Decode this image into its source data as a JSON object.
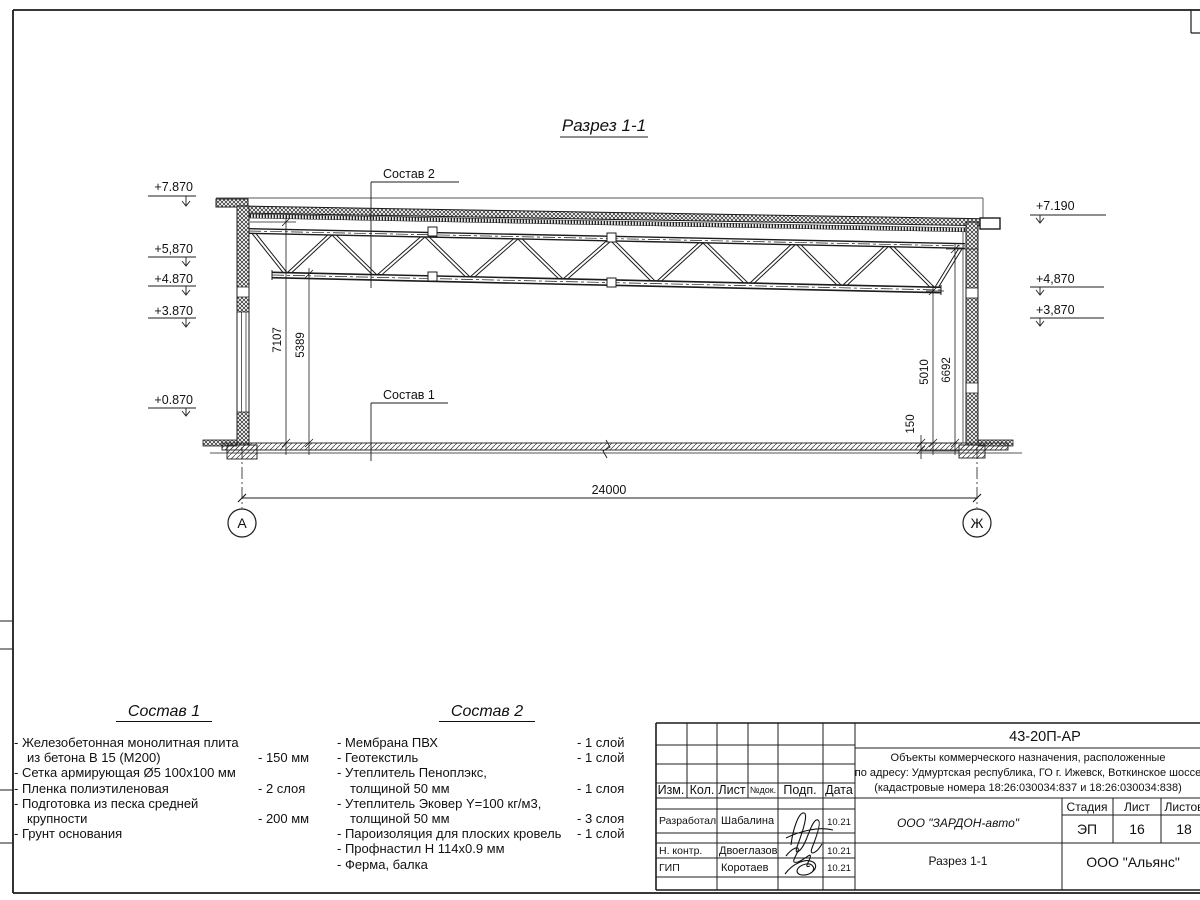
{
  "page": {
    "sheet_title": "Разрез 1-1"
  },
  "drawing": {
    "title": "Разрез 1-1",
    "leader1": "Состав 1",
    "leader2": "Состав 2",
    "dim_width": "24000",
    "dim_h_left1": "7107",
    "dim_h_left2": "5389",
    "dim_h_right1": "5010",
    "dim_h_right2": "6692",
    "dim_slab": "150",
    "axis_left": "А",
    "axis_right": "Ж",
    "elev_l1": "+7.870",
    "elev_l2": "+5,870",
    "elev_l3": "+4.870",
    "elev_l4": "+3.870",
    "elev_l5": "+0.870",
    "elev_r1": "+7.190",
    "elev_r2": "+4,870",
    "elev_r3": "+3,870"
  },
  "spec1": {
    "heading": "Состав 1",
    "rows": [
      {
        "t": "- Железобетонная  монолитная плита",
        "v": ""
      },
      {
        "t": "из бетона В 15 (М200)",
        "v": "- 150 мм"
      },
      {
        "t": "- Сетка армирующая Ø5 100х100 мм",
        "v": ""
      },
      {
        "t": "- Пленка полиэтиленовая",
        "v": "-  2 слоя"
      },
      {
        "t": "- Подготовка из песка средней",
        "v": ""
      },
      {
        "t": "крупности",
        "v": "- 200 мм"
      },
      {
        "t": "- Грунт основания",
        "v": ""
      }
    ]
  },
  "spec2": {
    "heading": "Состав 2",
    "rows": [
      {
        "t": "- Мембрана ПВХ",
        "v": "- 1 слой"
      },
      {
        "t": "- Геотекстиль",
        "v": "- 1 слой"
      },
      {
        "t": "- Утеплитель Пеноплэкс,",
        "v": ""
      },
      {
        "t": "толщиной 50 мм",
        "v": "- 1 слоя"
      },
      {
        "t": "- Утеплитель Эковер Y=100 кг/м3,",
        "v": ""
      },
      {
        "t": "толщиной 50 мм",
        "v": "- 3 слоя"
      },
      {
        "t": "- Пароизоляция для плоских кровель",
        "v": "- 1 слой"
      },
      {
        "t": "- Профнастил Н 114х0.9 мм",
        "v": ""
      },
      {
        "t": "- Ферма, балка",
        "v": ""
      }
    ]
  },
  "titleblock": {
    "doc_number": "43-20П-АР",
    "project_line1": "Объекты коммерческого назначения, расположенные",
    "project_line2": "по адресу: Удмуртская республика, ГО г. Ижевск, Воткинское шоссе",
    "project_line3": "(кадастровые номера 18:26:030034:837 и 18:26:030034:838)",
    "col_izm": "Изм.",
    "col_kol": "Кол.",
    "col_list": "Лист",
    "col_ndok": "№док.",
    "col_podp": "Подп.",
    "col_data": "Дата",
    "row1_role": "Разработал",
    "row1_name": "Шабалина",
    "row1_date": "10.21",
    "row2_role": "Н. контр.",
    "row2_name": "Двоеглазов",
    "row2_date": "10.21",
    "row3_role": "ГИП",
    "row3_name": "Коротаев",
    "row3_date": "10.21",
    "customer": "ООО \"ЗАРДОН-авто\"",
    "sheet_name": "Разрез 1-1",
    "contractor": "ООО \"Альянс\"",
    "stage_label": "Стадия",
    "list_label": "Лист",
    "listov_label": "Листов",
    "stage": "ЭП",
    "list_num": "16",
    "listov_num": "18"
  }
}
